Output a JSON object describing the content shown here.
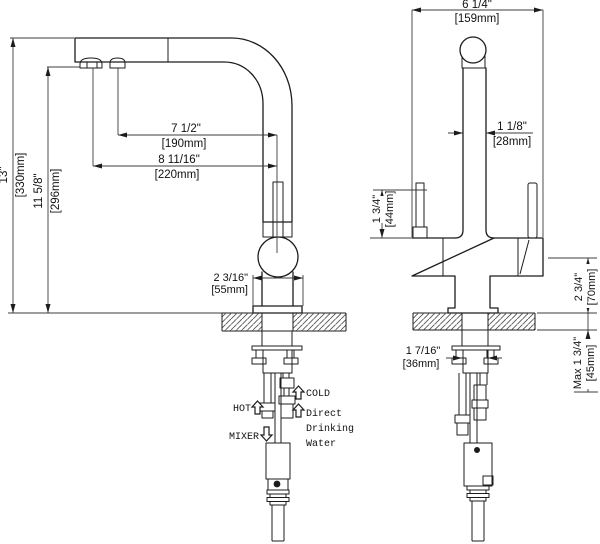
{
  "dimensions": {
    "overall_height": {
      "inches": "13\"",
      "metric": "[330mm]"
    },
    "height_to_spout": {
      "inches": "11 5/8\"",
      "metric": "[296mm]"
    },
    "spout_reach_inner": {
      "inches": "7 1/2\"",
      "metric": "[190mm]"
    },
    "spout_reach_outer": {
      "inches": "8 11/16\"",
      "metric": "[220mm]"
    },
    "base_width": {
      "inches": "2 3/16\"",
      "metric": "[55mm]"
    },
    "overall_width": {
      "inches": "6 1/4\"",
      "metric": "[159mm]"
    },
    "spout_tube_width": {
      "inches": "1 1/8\"",
      "metric": "[28mm]"
    },
    "outlet_height": {
      "inches": "1 3/4\"",
      "metric": "[44mm]"
    },
    "handle_clearance": {
      "inches": "2 3/4\"",
      "metric": "[70mm]"
    },
    "shank_width": {
      "inches": "1 7/16\"",
      "metric": "[36mm]"
    },
    "max_deck_thickness": {
      "inches": "Max 1 3/4\"",
      "metric": "[45mm]"
    }
  },
  "supply_labels": {
    "hot": "HOT",
    "cold": "COLD",
    "mixer": "MIXER",
    "direct_line1": "Direct",
    "direct_line2": "Drinking",
    "direct_line3": "Water"
  },
  "colors": {
    "line": "#1c1c1c",
    "background": "#ffffff",
    "hatch": "#555555"
  }
}
